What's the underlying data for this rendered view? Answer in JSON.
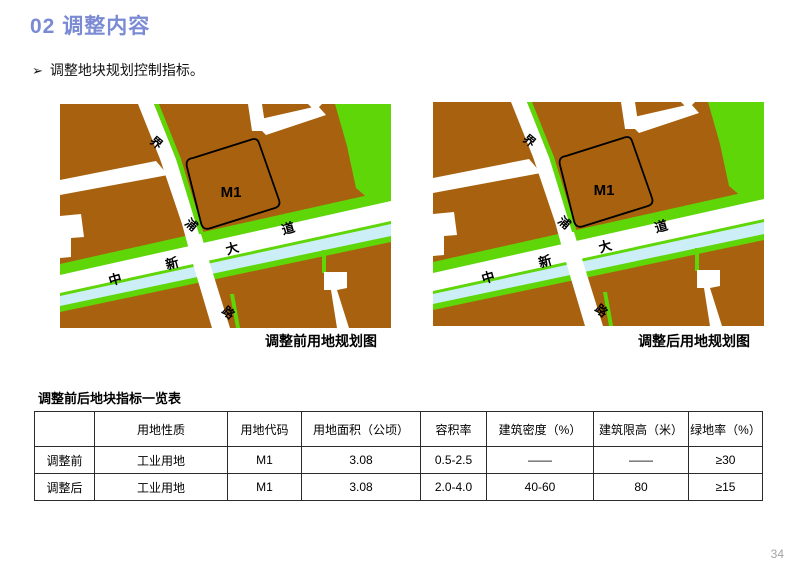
{
  "page": {
    "title": "02 调整内容",
    "bullet_marker": "➢",
    "bullet_text": "调整地块规划控制指标。",
    "page_number": "34",
    "title_color": "#7a8ad3"
  },
  "maps": {
    "before_caption": "调整前用地规划图",
    "after_caption": "调整后用地规划图",
    "labels": {
      "m1": "M1",
      "jie": "界",
      "pu": "浦",
      "lu": "路",
      "zhong": "中",
      "xin": "新",
      "da": "大",
      "dao": "道"
    },
    "colors": {
      "industrial_land": "#a8620f",
      "green_space": "#5fd608",
      "water": "#cceef6",
      "road": "#ffffff",
      "parcel_outline": "#000000"
    }
  },
  "table": {
    "title": "调整前后地块指标一览表",
    "headers": [
      "",
      "用地性质",
      "用地代码",
      "用地面积（公顷）",
      "容积率",
      "建筑密度（%）",
      "建筑限高（米）",
      "绿地率（%）"
    ],
    "rows": [
      {
        "label": "调整前",
        "cells": [
          "工业用地",
          "M1",
          "3.08",
          "0.5-2.5",
          "——",
          "——",
          "≥30"
        ]
      },
      {
        "label": "调整后",
        "cells": [
          "工业用地",
          "M1",
          "3.08",
          "2.0-4.0",
          "40-60",
          "80",
          "≥15"
        ]
      }
    ]
  }
}
